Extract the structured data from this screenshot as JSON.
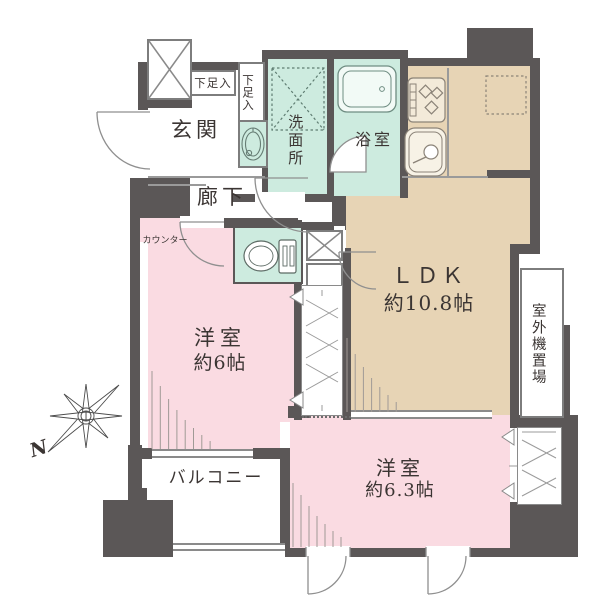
{
  "floorplan": {
    "labels": {
      "entrance": "玄関",
      "hallway": "廊下",
      "shoe_box_top": "下足入",
      "shoe_box_side": "下足入",
      "washroom": "洗面所",
      "bathroom": "浴室",
      "counter": "カウンター",
      "ldk_name": "ＬＤＫ",
      "ldk_size": "約10.8帖",
      "bedroom1_name": "洋室",
      "bedroom1_size": "約6帖",
      "bedroom2_name": "洋室",
      "bedroom2_size": "約6.3帖",
      "balcony": "バルコニー",
      "outdoor_unit": "室外機置場",
      "compass_north": "N"
    },
    "colors": {
      "wall": "#5b5757",
      "ldk_floor": "#e7d4b5",
      "bedroom_floor": "#fadbe2",
      "wet_area_floor": "#cdebdf",
      "background": "#ffffff"
    }
  }
}
